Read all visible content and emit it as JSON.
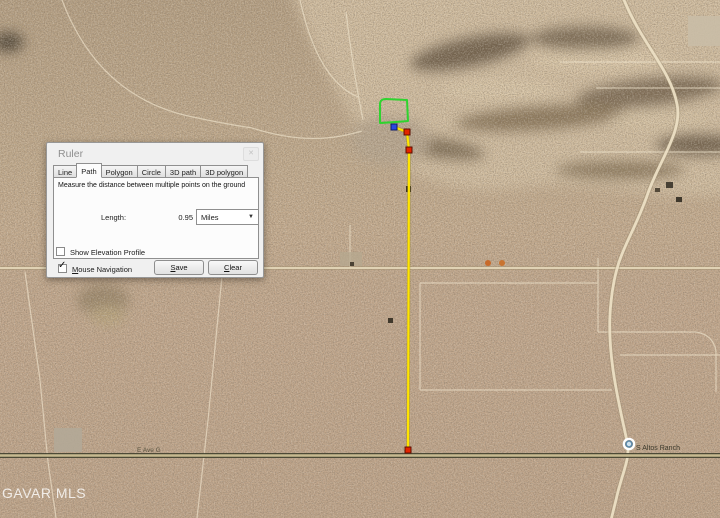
{
  "dialog": {
    "title": "Ruler",
    "close_icon": "✕",
    "tabs": [
      {
        "label": "Line"
      },
      {
        "label": "Path"
      },
      {
        "label": "Polygon"
      },
      {
        "label": "Circle"
      },
      {
        "label": "3D path"
      },
      {
        "label": "3D polygon"
      }
    ],
    "active_tab": "Path",
    "description": "Measure the distance between multiple points on the ground",
    "length_label": "Length:",
    "length_value": "0.95",
    "unit_selected": "Miles",
    "dropdown_arrow_icon": "▼",
    "elevation": {
      "label": "Show Elevation Profile",
      "checked": false
    },
    "mouse_nav": {
      "initial": "M",
      "rest": "ouse Navigation",
      "checked": true,
      "check_glyph": "✓"
    },
    "buttons": {
      "save_initial": "S",
      "save_rest": "ave",
      "clear_initial": "C",
      "clear_rest": "lear"
    }
  },
  "map": {
    "watermark": "GAVAR MLS",
    "road_labels": [
      {
        "text": "E Ave G"
      },
      {
        "text": "S Altos Ranch"
      }
    ],
    "measurement": {
      "length": "0.95",
      "unit": "Miles",
      "path_color": "#ffe400",
      "start_marker_color": "#2a47e0",
      "point_marker_color": "#e32400"
    },
    "parcel_outline_color": "#2fd32f"
  }
}
